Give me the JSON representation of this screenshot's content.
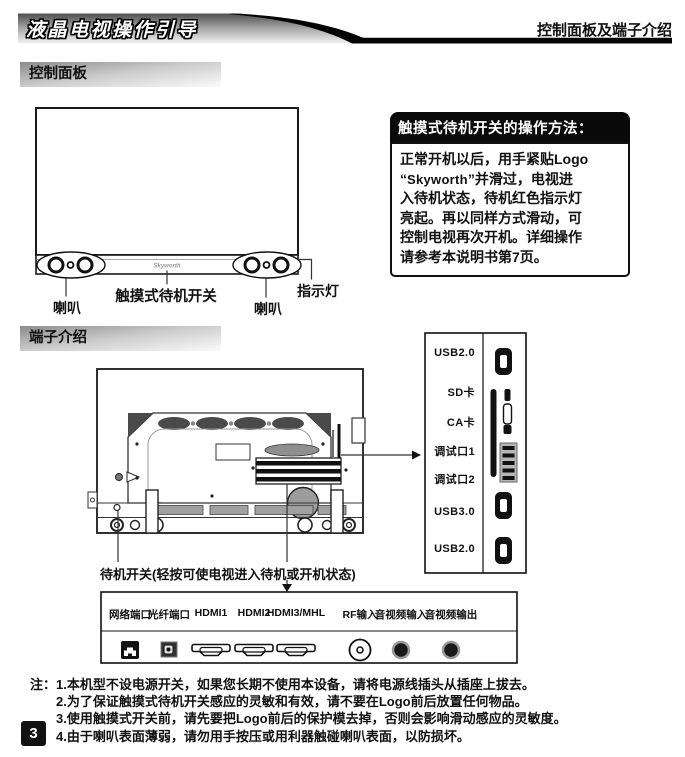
{
  "header": {
    "banner_title": "液晶电视操作引导",
    "page_subject": "控制面板及端子介绍"
  },
  "sections": {
    "control_panel": "控制面板",
    "ports": "端子介绍"
  },
  "front_tv": {
    "logo": "Skyworth",
    "speaker_left": "喇叭",
    "touch_switch": "触摸式待机开关",
    "speaker_right": "喇叭",
    "indicator": "指示灯"
  },
  "info_box": {
    "title": "触摸式待机开关的操作方法：",
    "line1": "正常开机以后，用手紧贴Logo",
    "line2_open_quote": "“",
    "line2_logo": "Skyworth",
    "line2_rest": "”并滑过，电视进",
    "line3": "入待机状态，待机红色指示灯",
    "line4": "亮起。再以同样方式滑动，可",
    "line5": "控制电视再次开机。详细操作",
    "line6": "请参考本说明书第7页。"
  },
  "side_panel": {
    "labels": [
      "USB2.0",
      "SD卡",
      "CA卡",
      "调试口1",
      "调试口2",
      "USB3.0",
      "USB2.0"
    ]
  },
  "back_tv": {
    "standby_label": "待机开关(轻按可使电视进入待机或开机状态)"
  },
  "bottom_panel": {
    "labels": [
      "网络端口",
      "光纤端口",
      "HDMI1",
      "HDMI2",
      "HDMI3/MHL",
      "RF输入",
      "音视频输入",
      "音视频输出"
    ]
  },
  "notes": {
    "prefix": "注：",
    "items": [
      "1.本机型不设电源开关，如果您长期不使用本设备，请将电源线插头从插座上拔去。",
      "2.为了保证触摸式待机开关感应的灵敏和有效，请不要在Logo前后放置任何物品。",
      "3.使用触摸式开关前，请先要把Logo前后的保护模去掉，否则会影响滑动感应的灵敏度。",
      "4.由于喇叭表面薄弱，请勿用手按压或用利器触碰喇叭表面，以防损坏。"
    ]
  },
  "page_number": "3"
}
